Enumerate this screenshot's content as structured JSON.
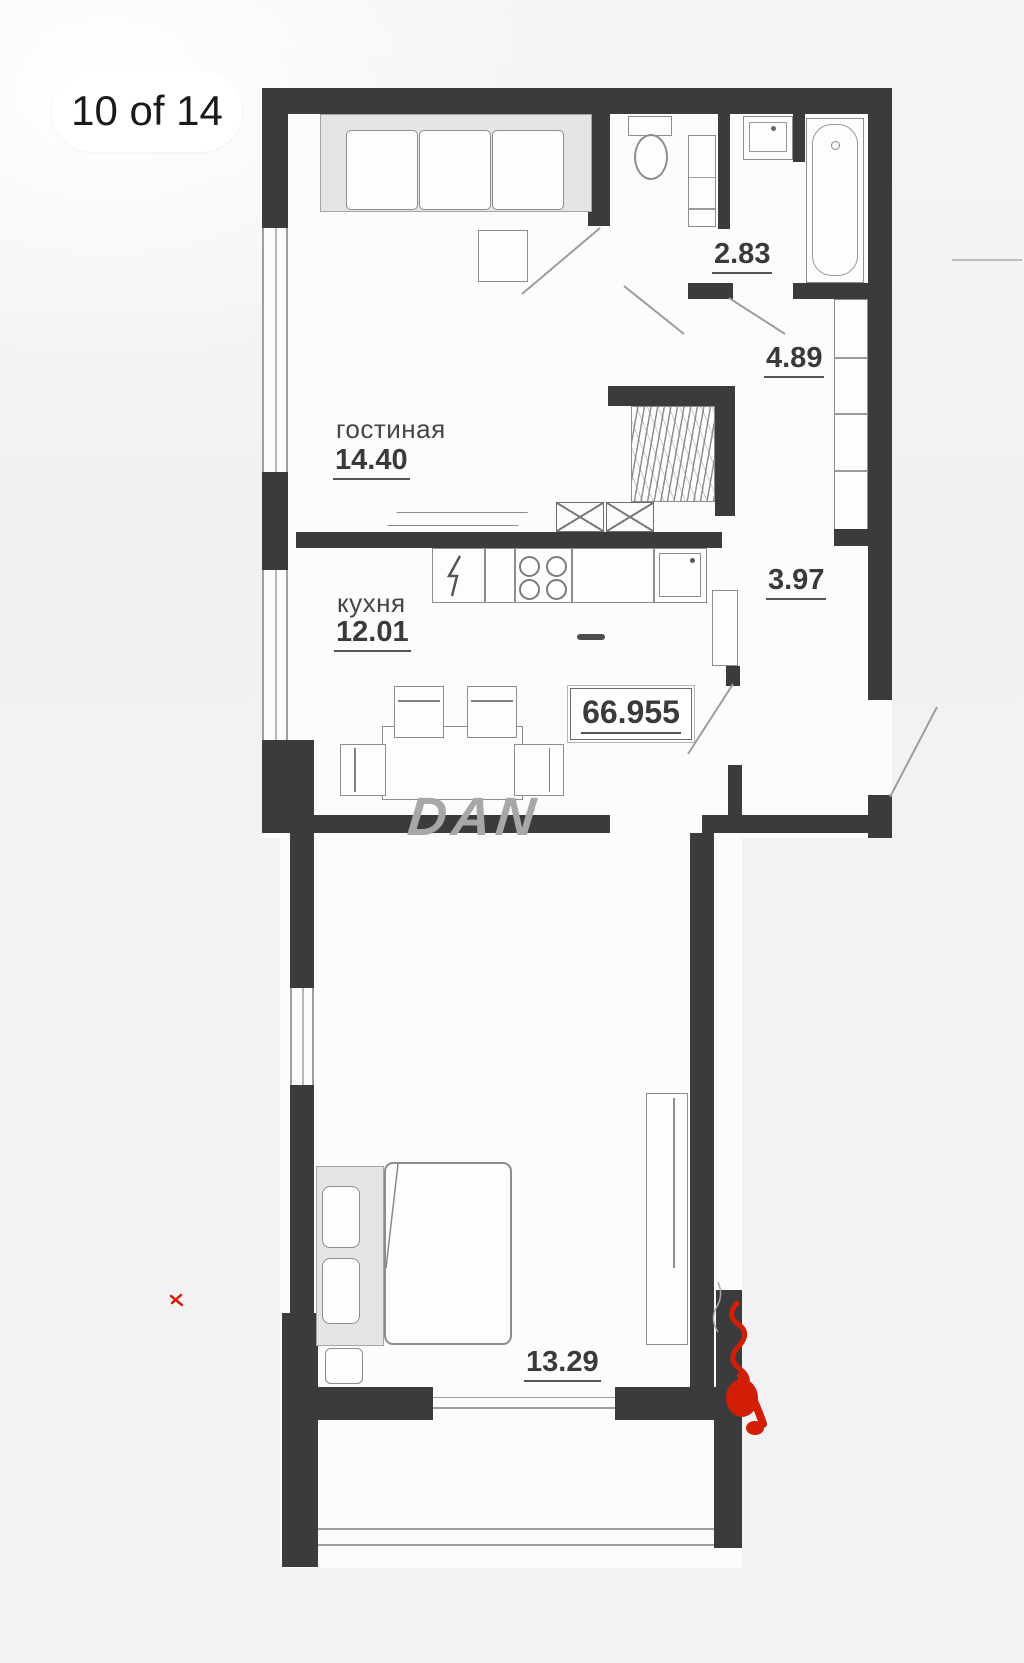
{
  "viewer": {
    "page_indicator": "10 of 14"
  },
  "plan": {
    "watermark": "DAN",
    "living": {
      "name": "гостиная",
      "area": "14.40"
    },
    "kitchen": {
      "name": "кухня",
      "area": "12.01"
    },
    "wc": {
      "area": "2.83"
    },
    "hall": {
      "area": "4.89"
    },
    "corridor": {
      "area": "3.97"
    },
    "bedroom": {
      "area": "13.29"
    },
    "total": {
      "area": "66.955"
    },
    "colors": {
      "wall": "#3b3b3d",
      "red_annotation": "#d21e04",
      "label_text": "#3a3a3a"
    }
  }
}
